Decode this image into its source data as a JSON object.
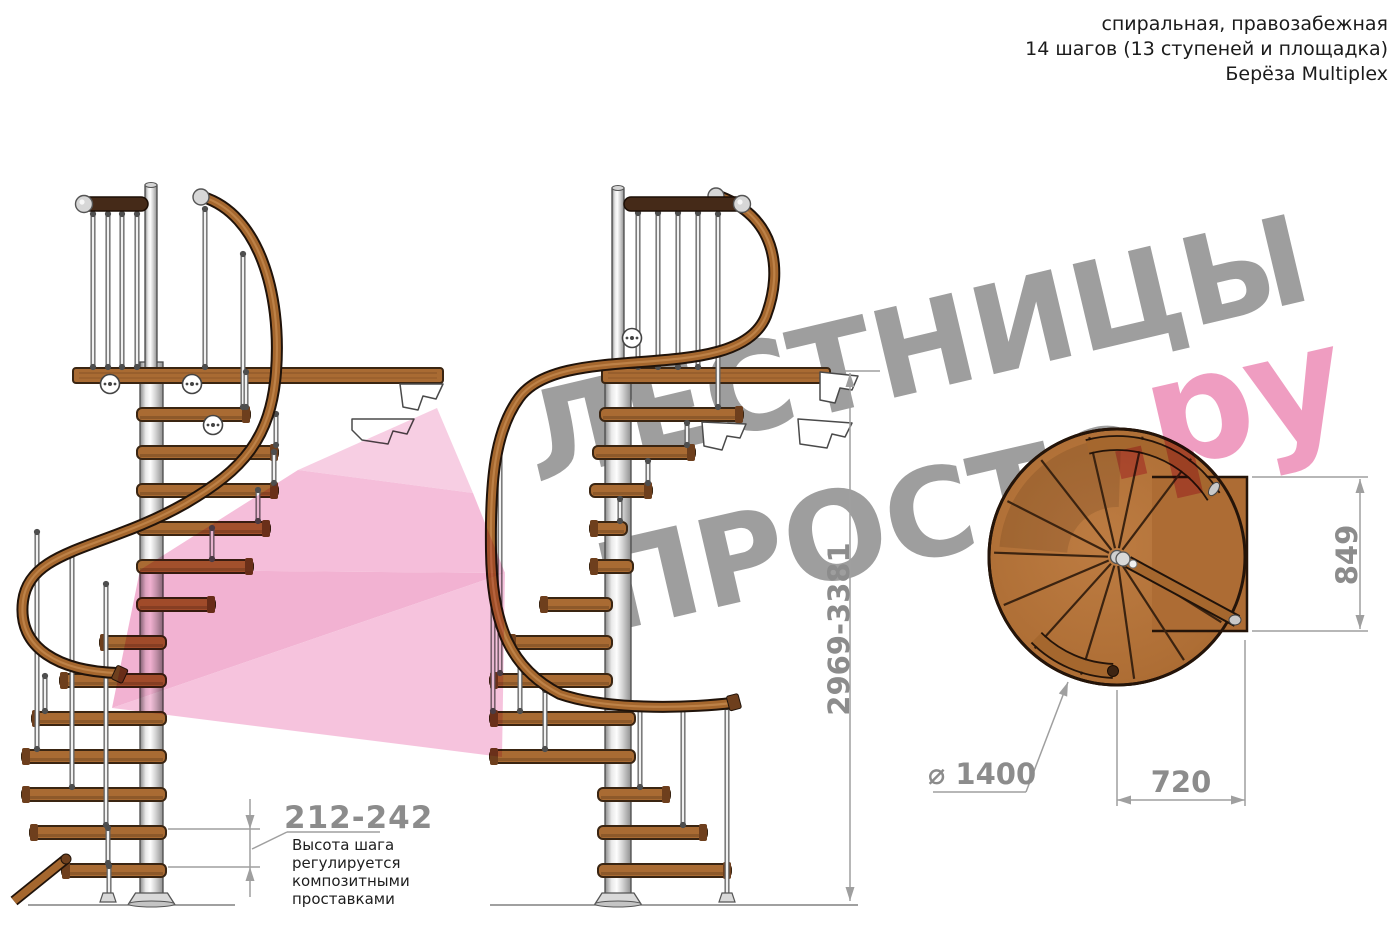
{
  "header": {
    "line1": "спиральная, правозабежная",
    "line2": "14 шагов (13 ступеней и площадка)",
    "line3": "Берёза Multiplex"
  },
  "watermark": {
    "line1": "ЛЕСТНИЦЫ",
    "line2": "ПРОСТО",
    "suffix": ".ру",
    "text_color": "#9e9e9e",
    "accent_color": "#ef9dc1"
  },
  "annotations": {
    "total_height": {
      "value": "2969-3381",
      "units": "mm",
      "orientation": "vertical"
    },
    "landing_side": {
      "value": "849",
      "units": "mm",
      "orientation": "vertical"
    },
    "landing_depth": {
      "value": "720",
      "units": "mm",
      "orientation": "horizontal"
    },
    "diameter": {
      "value": "⌀ 1400",
      "units": "mm"
    },
    "step_height": {
      "value": "212-242",
      "note_lines": [
        "Высота шага",
        "регулируется",
        "композитными",
        "проставками"
      ]
    }
  },
  "figure": {
    "colors": {
      "wood": "#a96b33",
      "wood_dark": "#6e3f1d",
      "wood_light": "#c98f55",
      "outline": "#3a2512",
      "walnut": "#452a18",
      "rail_dark": "#20130a",
      "rail_wood": "#a5672e",
      "metal_stroke": "#4a4a4a",
      "plan_line": "#241409",
      "dim_line": "#9f9f9f",
      "dim_text": "#8c8c8c",
      "floor": "#808080",
      "pink": [
        "#f7cbe1",
        "#f4bbd8",
        "#f1aed0",
        "#f5c0db"
      ]
    },
    "left_stair": {
      "pole": {
        "x": 140,
        "y": 362,
        "w": 23,
        "h": 533
      },
      "newel": {
        "x": 145,
        "y": 185,
        "w": 12,
        "h": 184
      },
      "platform": {
        "x": 73,
        "y": 368,
        "w": 370,
        "h": 15
      },
      "top_rail": {
        "x": 80,
        "y": 197,
        "w": 68,
        "h": 14,
        "ball": "left"
      },
      "rail_path": "M 203,197 C 258,214 282,292 276,372 C 271,438 243,470 186,503 C 104,550 30,548 23,601 C 17,649 60,671 117,673",
      "rail_ball": [
        201,
        197
      ],
      "rail_cap": {
        "x": 117,
        "y": 673,
        "angle": 25
      },
      "stub": [
        14,
        901,
        66,
        859
      ],
      "treads": [
        [
          137,
          250,
          408
        ],
        [
          137,
          278,
          446
        ],
        [
          137,
          278,
          484
        ],
        [
          137,
          270,
          522
        ],
        [
          137,
          253,
          560
        ],
        [
          137,
          215,
          598
        ],
        [
          100,
          166,
          636
        ],
        [
          60,
          166,
          674
        ],
        [
          32,
          166,
          712
        ],
        [
          22,
          166,
          750
        ],
        [
          22,
          166,
          788
        ],
        [
          30,
          166,
          826
        ],
        [
          62,
          166,
          864
        ]
      ],
      "posts": [
        [
          93,
          212,
          368
        ],
        [
          108,
          212,
          368
        ],
        [
          122,
          212,
          368
        ],
        [
          137,
          212,
          368
        ],
        [
          205,
          207,
          368
        ],
        [
          243,
          252,
          408
        ],
        [
          246,
          370,
          408
        ],
        [
          276,
          412,
          446
        ],
        [
          274,
          450,
          484
        ],
        [
          258,
          488,
          522
        ],
        [
          212,
          526,
          560
        ],
        [
          37,
          530,
          750
        ],
        [
          72,
          552,
          788
        ],
        [
          106,
          582,
          826
        ],
        [
          45,
          674,
          712
        ],
        [
          108,
          826,
          864
        ],
        [
          109,
          864,
          900
        ]
      ],
      "disks": [
        [
          110,
          384
        ],
        [
          192,
          384
        ],
        [
          213,
          425
        ]
      ],
      "brackets": [
        "M400,384 L443,384 L436,399 L423,396 L418,410 L403,407 Z",
        "M352,419 L414,419 L407,434 L393,431 L388,444 L362,440 L352,430 Z"
      ],
      "flange": {
        "cx": 151.5,
        "y": 893
      },
      "foot": [
        108,
        893
      ],
      "floor": [
        28,
        905,
        235,
        905
      ]
    },
    "middle_stair": {
      "pole": {
        "x": 605,
        "y": 362,
        "w": 26,
        "h": 533
      },
      "newel": {
        "x": 612,
        "y": 188,
        "w": 12,
        "h": 181
      },
      "platform": {
        "x": 602,
        "y": 368,
        "w": 228,
        "h": 15
      },
      "top_rail": {
        "x": 624,
        "y": 197,
        "w": 120,
        "h": 14,
        "ball": "right"
      },
      "rail_path": "M 716,195 C 775,215 784,268 766,316 C 737,388 562,338 519,398 C 495,431 490,480 491,551 C 492,626 511,669 560,694 C 612,712 700,707 731,703",
      "rail_ball": [
        716,
        196
      ],
      "rail_cap": {
        "x": 731,
        "y": 703,
        "angle": -15
      },
      "treads": [
        [
          600,
          743,
          408
        ],
        [
          593,
          695,
          446
        ],
        [
          590,
          652,
          484
        ],
        [
          590,
          627,
          522
        ],
        [
          590,
          633,
          560
        ],
        [
          540,
          612,
          598
        ],
        [
          508,
          612,
          636
        ],
        [
          490,
          612,
          674
        ],
        [
          490,
          635,
          712
        ],
        [
          490,
          635,
          750
        ],
        [
          598,
          670,
          788
        ],
        [
          598,
          707,
          826
        ],
        [
          598,
          731,
          864
        ]
      ],
      "posts": [
        [
          638,
          211,
          368
        ],
        [
          658,
          211,
          368
        ],
        [
          678,
          211,
          368
        ],
        [
          698,
          211,
          368
        ],
        [
          718,
          212,
          408
        ],
        [
          687,
          421,
          446
        ],
        [
          648,
          459,
          484
        ],
        [
          620,
          497,
          522
        ],
        [
          500,
          432,
          674
        ],
        [
          493,
          505,
          712
        ],
        [
          520,
          662,
          712
        ],
        [
          545,
          688,
          750
        ],
        [
          640,
          707,
          788
        ],
        [
          683,
          706,
          826
        ],
        [
          727,
          705,
          900
        ]
      ],
      "disks": [
        [
          632,
          338
        ]
      ],
      "brackets": [
        "M820,372 L858,376 L852,390 L840,388 L835,403 L820,400 Z",
        "M798,419 L852,423 L845,437 L832,434 L827,448 L800,444 Z",
        "M702,422 L746,424 L740,438 L727,436 L722,450 L704,446 Z"
      ],
      "flange": {
        "cx": 618,
        "y": 893
      },
      "foot": [
        727,
        893
      ],
      "floor": [
        490,
        905,
        858,
        905
      ]
    },
    "plan": {
      "cx": 1117,
      "cy": 557,
      "r": 128,
      "radial_angles": [
        32,
        57,
        82,
        107,
        132,
        157,
        182,
        207,
        232,
        257,
        282,
        307
      ],
      "landing": {
        "x": 1152,
        "y": 477,
        "w": 95,
        "h": 154
      },
      "band": {
        "r": 114,
        "top": [
          255,
          328
        ],
        "bottom": [
          135,
          92
        ]
      },
      "diag_rail": [
        1128,
        562,
        1237,
        621
      ],
      "caps": {
        "band_end": [
          1214,
          489,
          35
        ],
        "band_dark": [
          1113,
          671
        ],
        "diag_end": [
          1235,
          620
        ],
        "center_ball": [
          1123,
          559
        ],
        "pin": [
          1133,
          564
        ]
      }
    },
    "pink_arrow": [
      "298,470 437,408 473,493",
      "140,570 298,470 473,493 505,573",
      "140,570 505,573 112,708",
      "112,708 505,573 502,757"
    ]
  }
}
